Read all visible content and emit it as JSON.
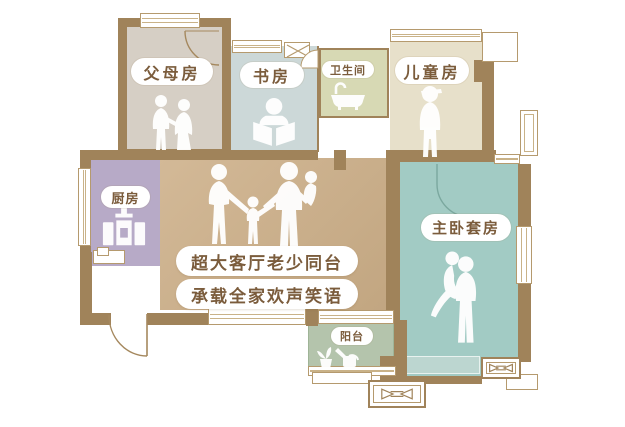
{
  "plan": {
    "rooms": [
      {
        "id": "parents",
        "label": "父母房"
      },
      {
        "id": "study",
        "label": "书房"
      },
      {
        "id": "bathroom",
        "label": "卫生间"
      },
      {
        "id": "children",
        "label": "儿童房"
      },
      {
        "id": "master",
        "label": "主卧套房"
      },
      {
        "id": "kitchen",
        "label": "厨房"
      },
      {
        "id": "balcony",
        "label": "阳台"
      }
    ],
    "caption": {
      "line1": "超大客厅老少同台",
      "line2": "承载全家欢声笑语"
    },
    "colors": {
      "wall": "#a0835a",
      "living_room": "#c9ae8e",
      "parents_room": "#d6cfc5",
      "study": "#ccd8d8",
      "bathroom": "#d7d9b4",
      "children_room": "#e7e0ca",
      "master_suite": "#a2cbc4",
      "kitchen": "#b7aac7",
      "balcony": "#b4c4ac",
      "label_text": "#7b5c3c",
      "window_line": "#b59a6e",
      "silhouette": "#ffffff"
    }
  }
}
